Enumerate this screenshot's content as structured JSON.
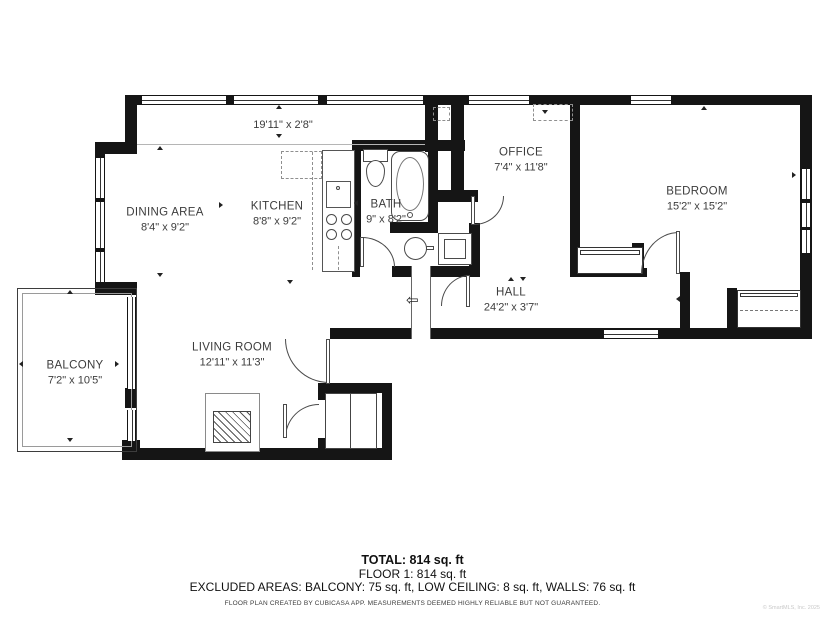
{
  "floorplan": {
    "strip": {
      "dims": "19'11\" x 2'8\""
    },
    "rooms": {
      "dining": {
        "name": "DINING AREA",
        "dims": "8'4\" x 9'2\""
      },
      "kitchen": {
        "name": "KITCHEN",
        "dims": "8'8\" x 9'2\""
      },
      "bath": {
        "name": "BATH",
        "dims": "9\" x 8'2\""
      },
      "office": {
        "name": "OFFICE",
        "dims": "7'4\" x 11'8\""
      },
      "bedroom": {
        "name": "BEDROOM",
        "dims": "15'2\" x 15'2\""
      },
      "hall": {
        "name": "HALL",
        "dims": "24'2\" x 3'7\""
      },
      "living": {
        "name": "LIVING ROOM",
        "dims": "12'11\" x 11'3\""
      },
      "balcony": {
        "name": "BALCONY",
        "dims": "7'2\" x 10'5\""
      }
    },
    "icons": {
      "entry_arrow": "⇦"
    },
    "footer": {
      "total": "TOTAL: 814 sq. ft",
      "floor": "FLOOR 1: 814 sq. ft",
      "excluded": "EXCLUDED AREAS: BALCONY: 75 sq. ft, LOW CEILING: 8 sq. ft, WALLS: 76 sq. ft",
      "disclaimer": "FLOOR PLAN CREATED BY CUBICASA APP. MEASUREMENTS DEEMED HIGHLY RELIABLE BUT NOT GUARANTEED.",
      "watermark": "© SmartMLS, Inc. 2025"
    },
    "colors": {
      "wall": "#151515",
      "label": "#3c3c3c"
    }
  }
}
